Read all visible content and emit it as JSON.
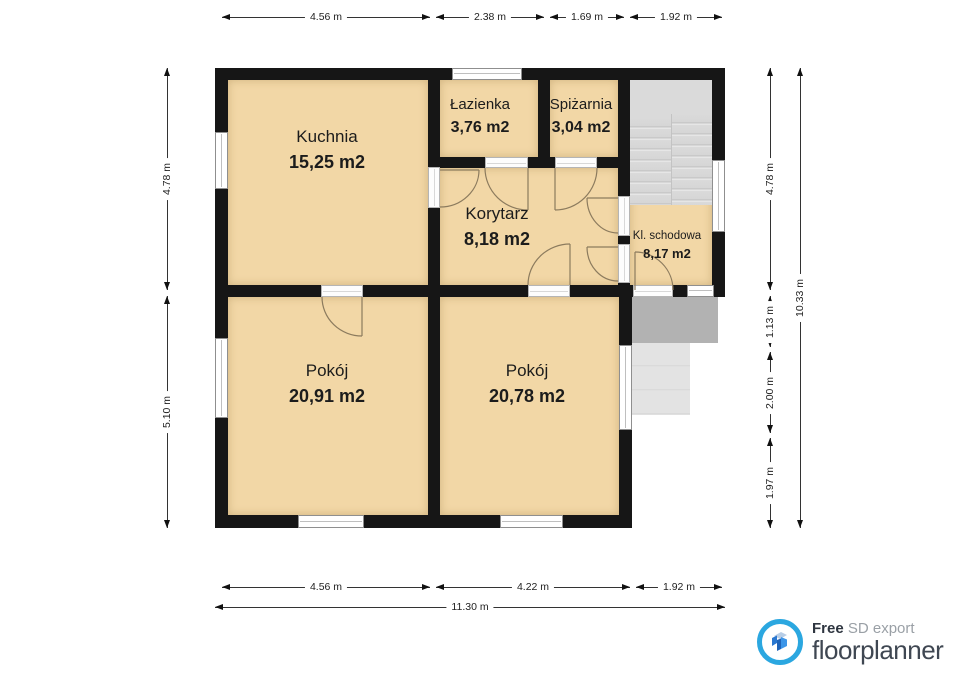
{
  "colors": {
    "room_fill": "#f2d7a6",
    "wall": "#161616",
    "stairs_gray": "#dadada",
    "porch_gray": "#b2b2b2",
    "steps_gray": "#e3e3e3",
    "door_arc": "#8c7b5e",
    "logo_blue": "#2ba7e0"
  },
  "rooms": [
    {
      "name": "Kuchnia",
      "area": "15,25 m2"
    },
    {
      "name": "Łazienka",
      "area": "3,76 m2"
    },
    {
      "name": "Spiżarnia",
      "area": "3,04 m2"
    },
    {
      "name": "Korytarz",
      "area": "8,18 m2"
    },
    {
      "name": "Kl. schodowa",
      "area": "8,17 m2"
    },
    {
      "name": "Pokój",
      "area": "20,91 m2"
    },
    {
      "name": "Pokój",
      "area": "20,78 m2"
    }
  ],
  "dimensions": {
    "top": [
      "4.56 m",
      "2.38 m",
      "1.69 m",
      "1.92 m"
    ],
    "left": [
      "4.78 m",
      "5.10 m"
    ],
    "right": [
      "4.78 m",
      "1.13 m",
      "2.00 m",
      "1.97 m"
    ],
    "right_total": "10.33 m",
    "bottom": [
      "4.56 m",
      "4.22 m",
      "1.92 m"
    ],
    "bottom_total": "11.30 m"
  },
  "logo": {
    "free": "Free",
    "export": " SD export",
    "brand": "floorplanner"
  }
}
